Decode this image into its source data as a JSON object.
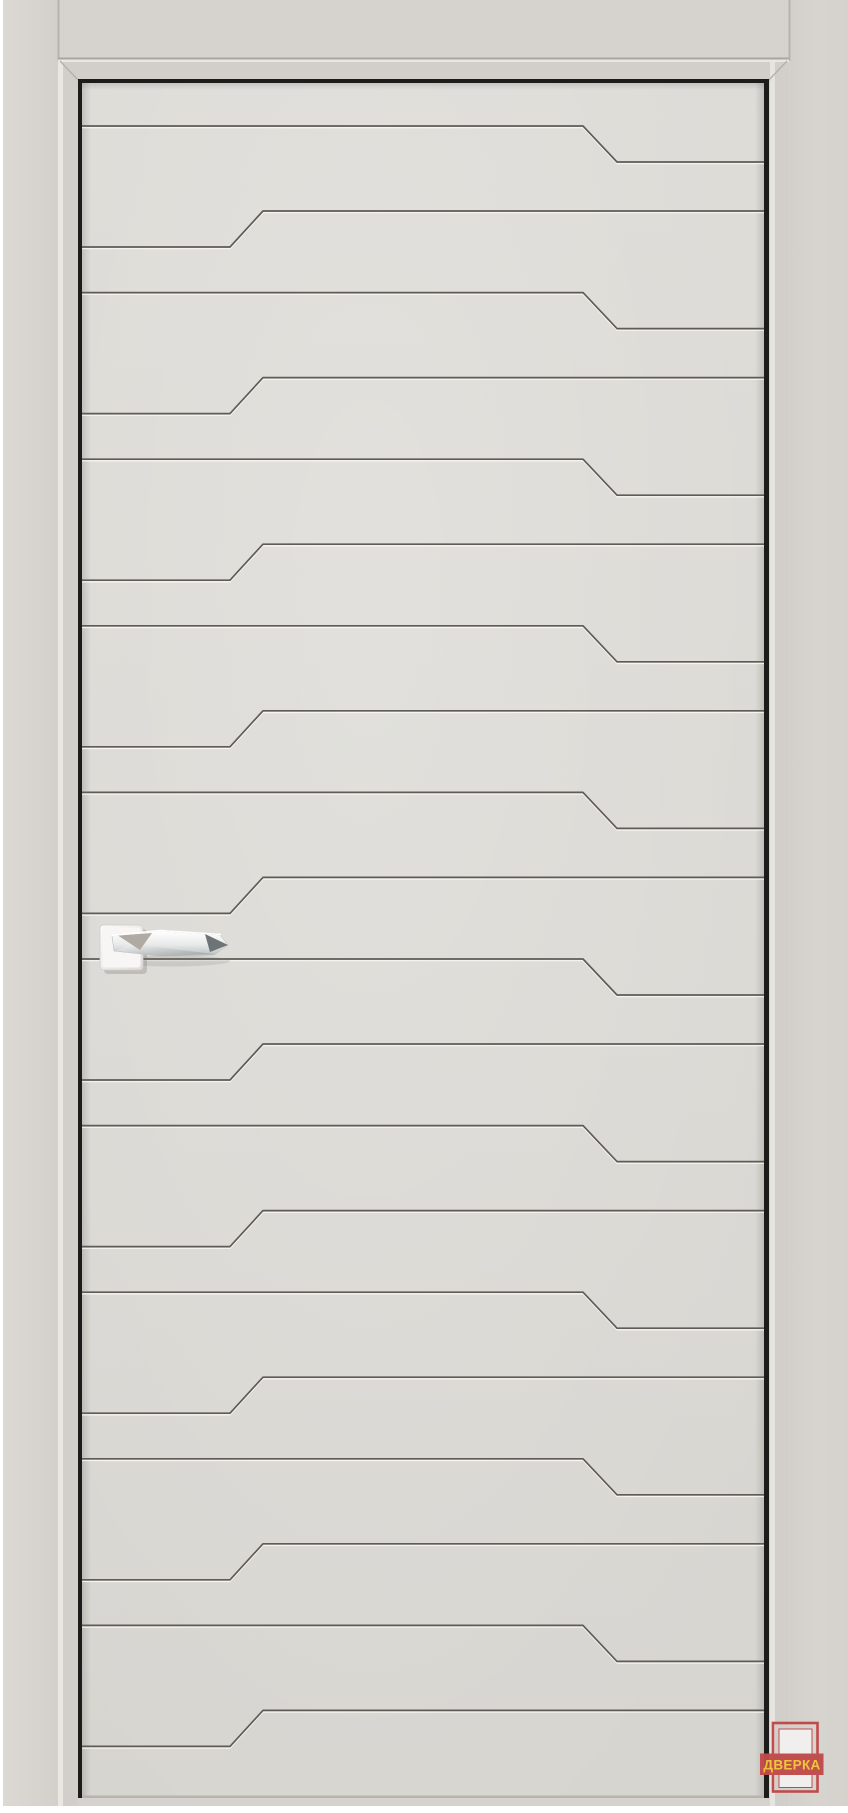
{
  "watermark": {
    "text": "ДВЕРКА",
    "icon": "door-outline-icon",
    "red": "#c24a4a",
    "yellow": "#f1c53b"
  },
  "colors": {
    "background": "#ffffff",
    "casing": "#d6d3ce",
    "jamb": "#d2cfca",
    "jamb_highlight": "#e9e7e2",
    "leaf": "#dad8d3",
    "groove": "#5f5c57",
    "groove_highlight": "rgba(252,251,248,0.8)",
    "door_gap": "#1d1c1a",
    "seam": "#b3b0ab",
    "handle_chrome": "#e8eaea",
    "handle_dark_facet": "#6e7375",
    "rosette": "#f7f6f4"
  },
  "pattern": {
    "rows": 10,
    "period": 166.6,
    "leaf_box": {
      "x": 82,
      "y": 83,
      "w": 682,
      "h": 1715
    },
    "line_a": {
      "y0": 126,
      "jog_x1": 583,
      "jog_x2": 617,
      "dy": 36
    },
    "line_b": {
      "y0": 247,
      "jog_x1": 230,
      "jog_x2": 263,
      "dy": -36
    }
  }
}
